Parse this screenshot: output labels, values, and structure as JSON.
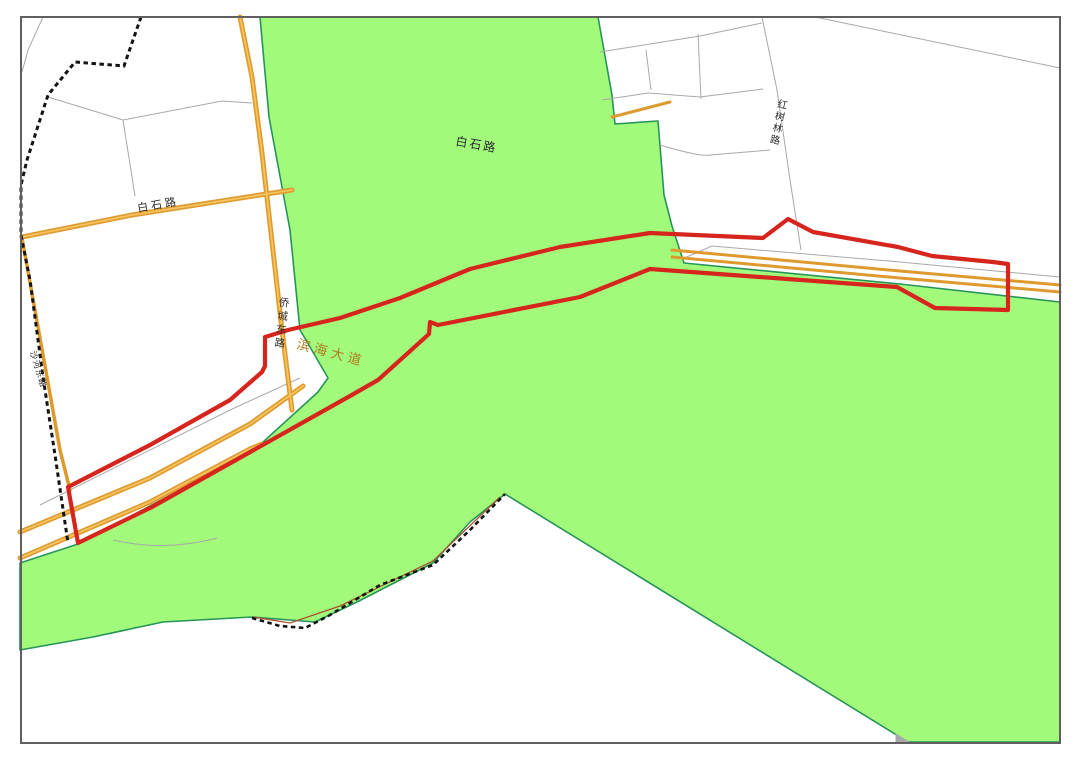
{
  "map": {
    "labels": {
      "baishi_center": {
        "text": "白石路"
      },
      "baishi_west": {
        "text": "白石路"
      },
      "qiaocheng_east": {
        "text": "侨城东路"
      },
      "binhai_avenue": {
        "text": "滨海大道"
      },
      "hongshulin": {
        "text": "红树林路"
      },
      "shahe_east": {
        "text": "沙河东路"
      }
    },
    "colors": {
      "background": "#ffffff",
      "green_fill": "#a2fa7b",
      "green_edge": "#28945a",
      "road_orange": "#de9a2e",
      "road_orange_core": "#f6c35f",
      "boundary_red": "#d6251c",
      "admin_dash": "#141414",
      "parcel_gray": "#a8a8a8",
      "contour_brown": "#a8522e",
      "frame_gray": "#5f5f5f",
      "label_dark": "#2b2b2b",
      "binhai_label": "#b07d20"
    }
  }
}
